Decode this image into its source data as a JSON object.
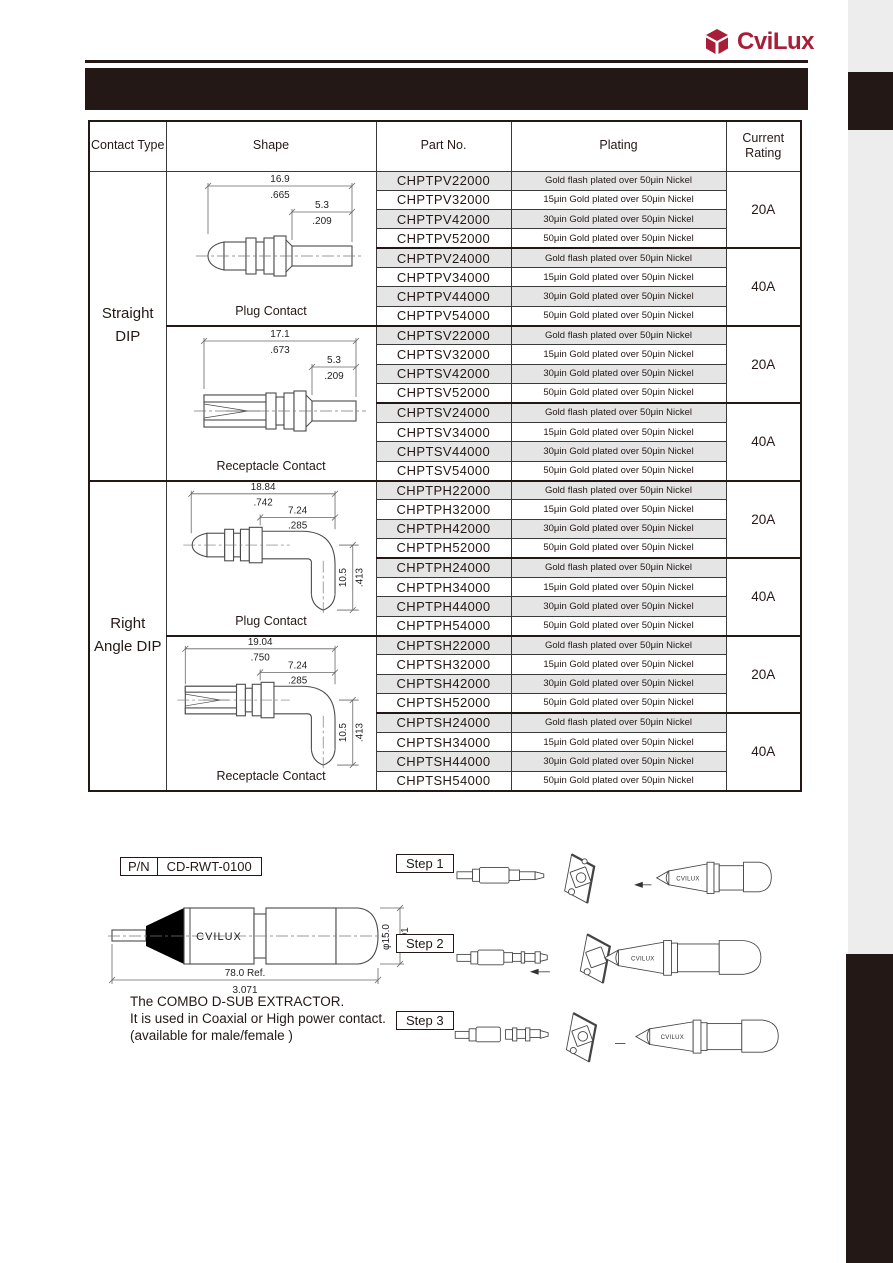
{
  "brand": {
    "name": "CviLux",
    "accent_color": "#A91E37",
    "band_color": "#231815"
  },
  "table": {
    "headers": {
      "contact_type": "Contact Type",
      "shape": "Shape",
      "part_no": "Part No.",
      "plating": "Plating",
      "current_rating": "Current Rating"
    },
    "contact_types": [
      "Straight DIP",
      "Right Angle DIP"
    ],
    "shapes": [
      {
        "label": "Plug Contact",
        "dims": {
          "len_mm": "16.9",
          "len_in": ".665",
          "tail_mm": "5.3",
          "tail_in": ".209"
        }
      },
      {
        "label": "Receptacle Contact",
        "dims": {
          "len_mm": "17.1",
          "len_in": ".673",
          "tail_mm": "5.3",
          "tail_in": ".209"
        }
      },
      {
        "label": "Plug Contact",
        "dims": {
          "len_mm": "18.84",
          "len_in": ".742",
          "tail_mm": "7.24",
          "tail_in": ".285",
          "drop_mm": "10.5",
          "drop_in": ".413"
        }
      },
      {
        "label": "Receptacle Contact",
        "dims": {
          "len_mm": "19.04",
          "len_in": ".750",
          "tail_mm": "7.24",
          "tail_in": ".285",
          "drop_mm": "10.5",
          "drop_in": ".413"
        }
      }
    ],
    "ratings": [
      "20A",
      "40A",
      "20A",
      "40A",
      "20A",
      "40A",
      "20A",
      "40A"
    ],
    "rows": [
      {
        "part_no": "CHPTPV22000",
        "plating": "Gold flash plated over 50μin Nickel"
      },
      {
        "part_no": "CHPTPV32000",
        "plating": "15μin Gold plated over 50μin Nickel"
      },
      {
        "part_no": "CHPTPV42000",
        "plating": "30μin Gold plated over 50μin Nickel"
      },
      {
        "part_no": "CHPTPV52000",
        "plating": "50μin Gold plated over 50μin Nickel"
      },
      {
        "part_no": "CHPTPV24000",
        "plating": "Gold flash plated over 50μin Nickel"
      },
      {
        "part_no": "CHPTPV34000",
        "plating": "15μin Gold plated over 50μin Nickel"
      },
      {
        "part_no": "CHPTPV44000",
        "plating": "30μin Gold plated over 50μin Nickel"
      },
      {
        "part_no": "CHPTPV54000",
        "plating": "50μin Gold plated over 50μin Nickel"
      },
      {
        "part_no": "CHPTSV22000",
        "plating": "Gold flash plated over 50μin Nickel"
      },
      {
        "part_no": "CHPTSV32000",
        "plating": "15μin Gold plated over 50μin Nickel"
      },
      {
        "part_no": "CHPTSV42000",
        "plating": "30μin Gold plated over 50μin Nickel"
      },
      {
        "part_no": "CHPTSV52000",
        "plating": "50μin Gold plated over 50μin Nickel"
      },
      {
        "part_no": "CHPTSV24000",
        "plating": "Gold flash plated over 50μin Nickel"
      },
      {
        "part_no": "CHPTSV34000",
        "plating": "15μin Gold plated over 50μin Nickel"
      },
      {
        "part_no": "CHPTSV44000",
        "plating": "30μin Gold plated over 50μin Nickel"
      },
      {
        "part_no": "CHPTSV54000",
        "plating": "50μin Gold plated over 50μin Nickel"
      },
      {
        "part_no": "CHPTPH22000",
        "plating": "Gold flash plated over 50μin Nickel"
      },
      {
        "part_no": "CHPTPH32000",
        "plating": "15μin Gold plated over 50μin Nickel"
      },
      {
        "part_no": "CHPTPH42000",
        "plating": "30μin Gold plated over 50μin Nickel"
      },
      {
        "part_no": "CHPTPH52000",
        "plating": "50μin Gold plated over 50μin Nickel"
      },
      {
        "part_no": "CHPTPH24000",
        "plating": "Gold flash plated over 50μin Nickel"
      },
      {
        "part_no": "CHPTPH34000",
        "plating": "15μin Gold plated over 50μin Nickel"
      },
      {
        "part_no": "CHPTPH44000",
        "plating": "30μin Gold plated over 50μin Nickel"
      },
      {
        "part_no": "CHPTPH54000",
        "plating": "50μin Gold plated over 50μin Nickel"
      },
      {
        "part_no": "CHPTSH22000",
        "plating": "Gold flash plated over 50μin Nickel"
      },
      {
        "part_no": "CHPTSH32000",
        "plating": "15μin Gold plated over 50μin Nickel"
      },
      {
        "part_no": "CHPTSH42000",
        "plating": "30μin Gold plated over 50μin Nickel"
      },
      {
        "part_no": "CHPTSH52000",
        "plating": "50μin Gold plated over 50μin Nickel"
      },
      {
        "part_no": "CHPTSH24000",
        "plating": "Gold flash plated over 50μin Nickel"
      },
      {
        "part_no": "CHPTSH34000",
        "plating": "15μin Gold plated over 50μin Nickel"
      },
      {
        "part_no": "CHPTSH44000",
        "plating": "30μin Gold plated over 50μin Nickel"
      },
      {
        "part_no": "CHPTSH54000",
        "plating": "50μin Gold plated over 50μin Nickel"
      }
    ]
  },
  "extractor": {
    "pn_label": "P/N",
    "pn_value": "CD-RWT-0100",
    "body_text": "CVILUX",
    "length_mm": "78.0 Ref.",
    "length_in": "3.071",
    "dia_mm": "φ15.0",
    "dia_in": ".591",
    "desc_line1": "The COMBO D-SUB EXTRACTOR.",
    "desc_line2": "It is used in Coaxial or High power contact.",
    "desc_line3": "(available for male/female )"
  },
  "steps": [
    {
      "label": "Step 1",
      "tool_text": "CVILUX"
    },
    {
      "label": "Step 2",
      "tool_text": "CVILUX"
    },
    {
      "label": "Step 3",
      "tool_text": "CVILUX"
    }
  ]
}
